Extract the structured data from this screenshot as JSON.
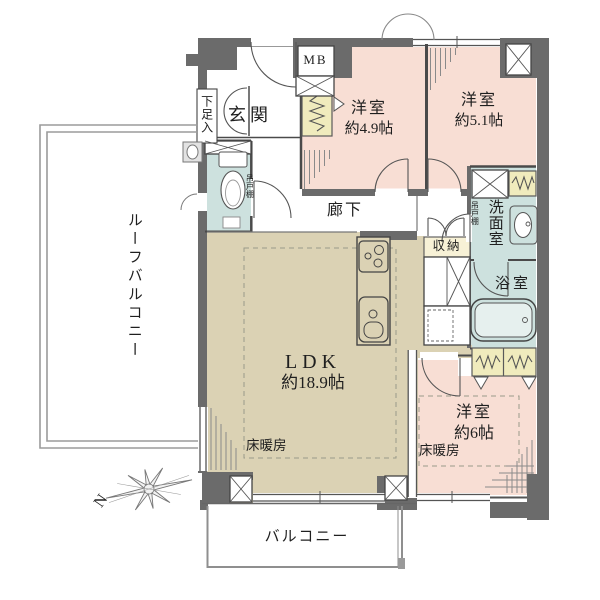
{
  "labels": {
    "roof_balcony": "ルーフバルコニー",
    "entrance": "玄関",
    "shoe_cabinet": "下足入",
    "toilet_shelf": "吊戸棚",
    "meter_box": "MB",
    "bedroom1_name": "洋室",
    "bedroom1_size": "約4.9帖",
    "bedroom2_name": "洋室",
    "bedroom2_size": "約5.1帖",
    "hallway": "廊下",
    "washroom": "洗面室",
    "washroom_shelf": "吊戸棚",
    "bathroom": "浴室",
    "storage": "収納",
    "ldk_name": "LDK",
    "ldk_size": "約18.9帖",
    "ldk_floor_heating": "床暖房",
    "bedroom3_name": "洋室",
    "bedroom3_size": "約6帖",
    "bedroom3_floor_heating": "床暖房",
    "balcony": "バルコニー",
    "compass_north": "N"
  },
  "colors": {
    "wall": "#6b6b6b",
    "room_pink": "#f8ded4",
    "room_beige": "#dbd2b4",
    "room_teal": "#cde1de",
    "closet_yellow": "#f0ebbd",
    "storage_cream": "#f7f1d6"
  }
}
